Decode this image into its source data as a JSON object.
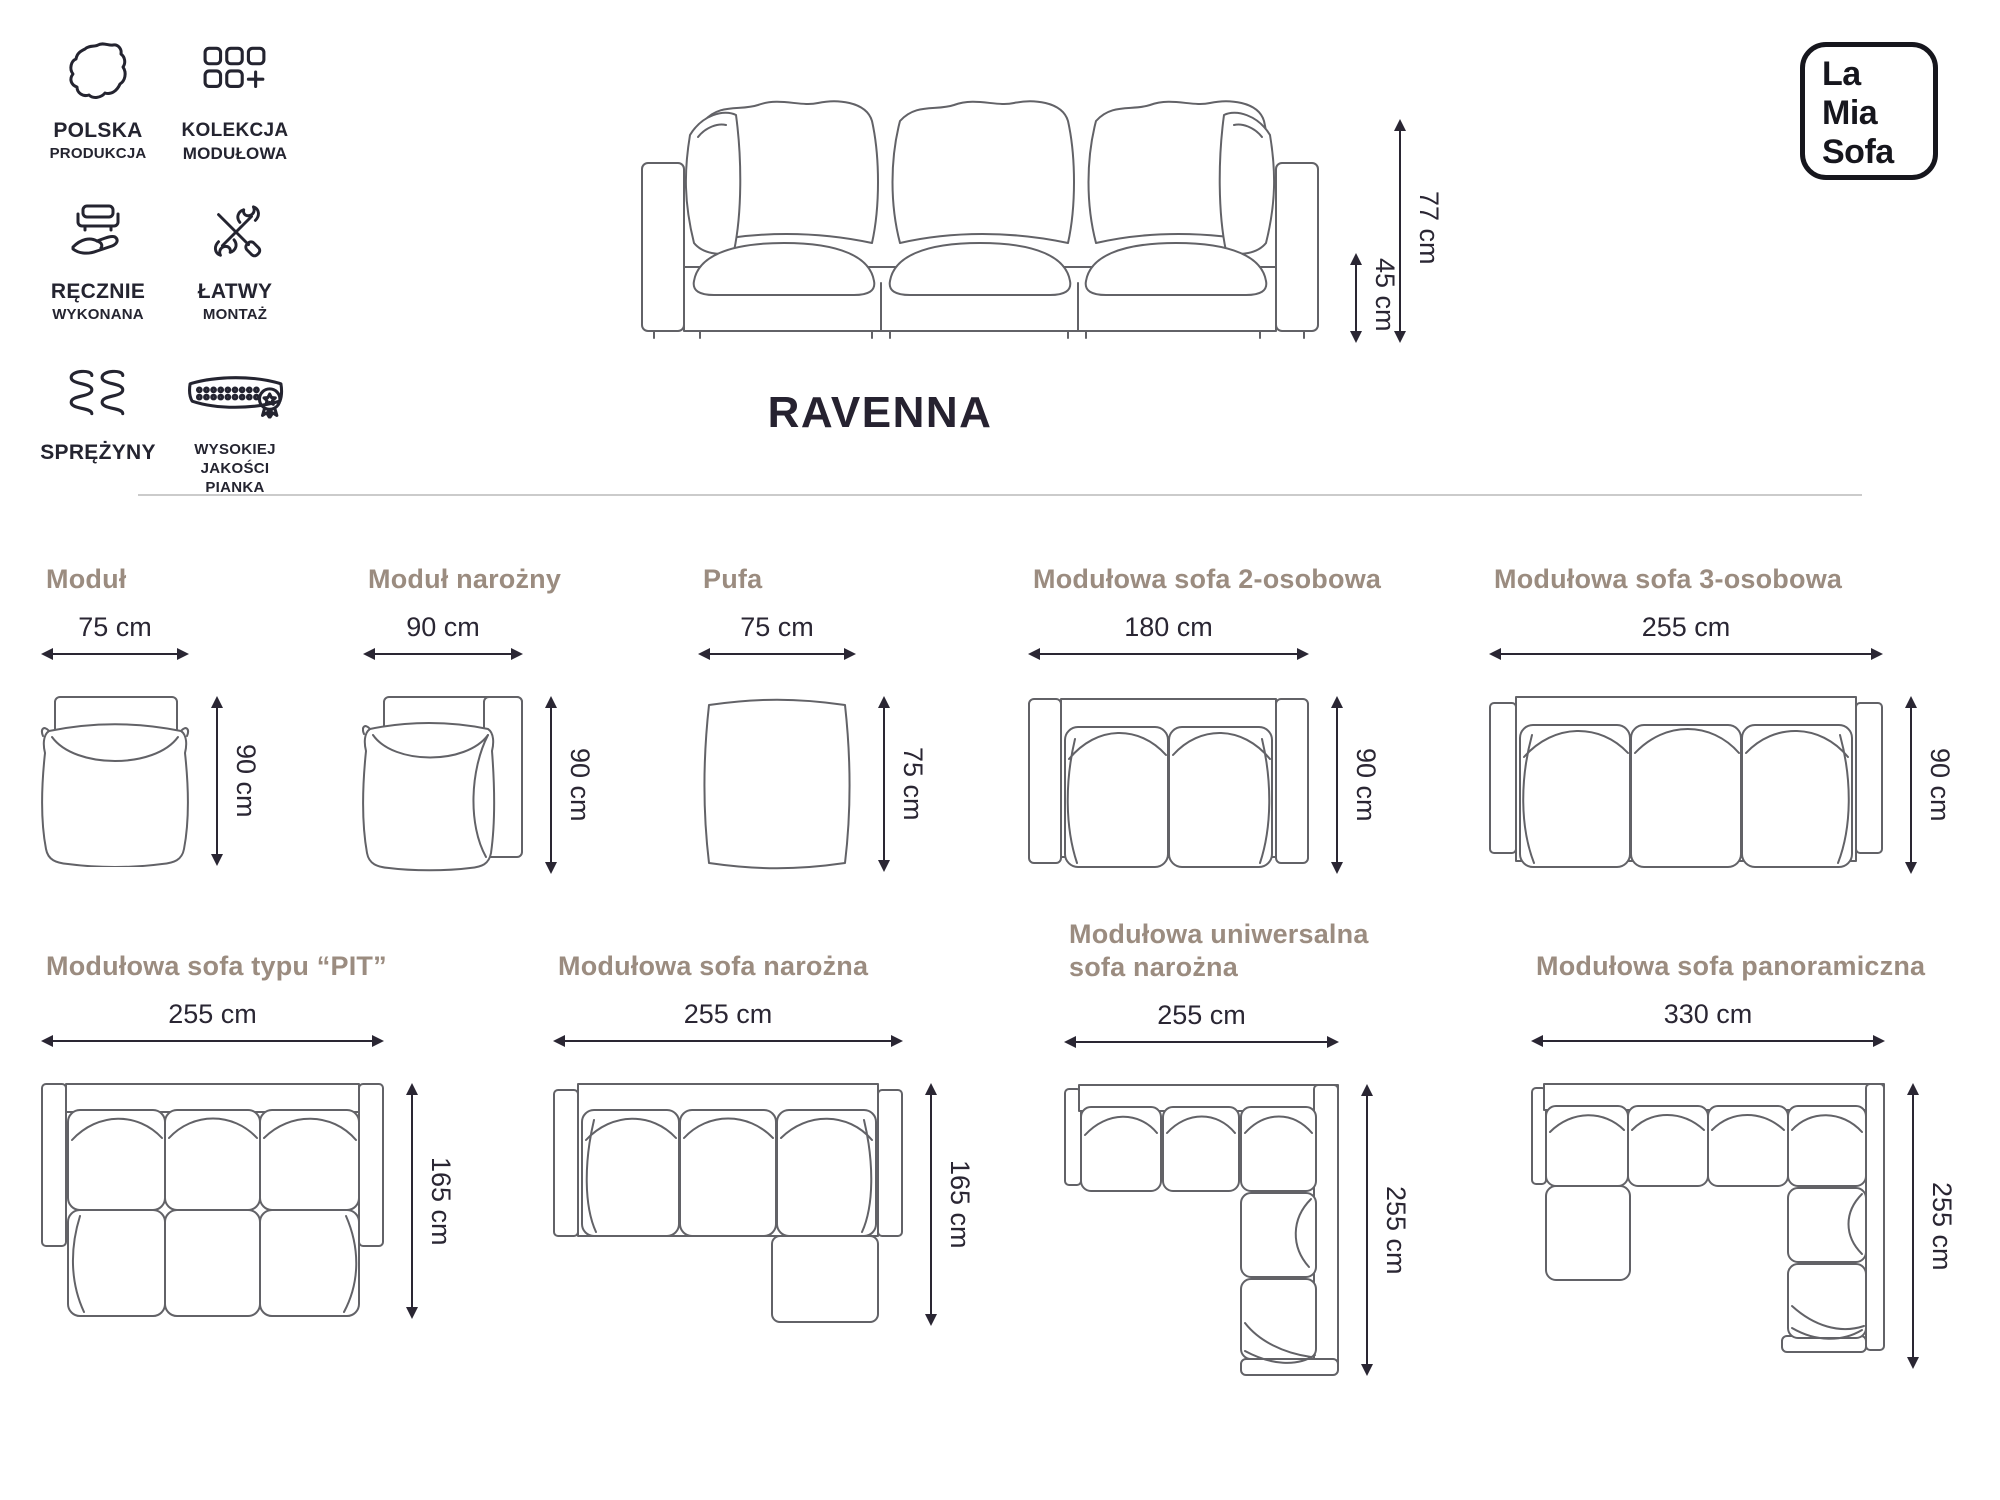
{
  "colors": {
    "label_accent": "#9b8c80",
    "ink": "#2a2633",
    "drawing_line": "#626267",
    "divider": "#cbcbcb",
    "logo_ink": "#16161d"
  },
  "badges": [
    {
      "icon": "poland-map-icon",
      "line1": "POLSKA",
      "line2": "PRODUKCJA"
    },
    {
      "icon": "modular-collection-icon",
      "line1": "KOLEKCJA",
      "line2": "MODUŁOWA"
    },
    {
      "icon": "handmade-icon",
      "line1": "RĘCZNIE",
      "line2": "WYKONANA"
    },
    {
      "icon": "easy-assembly-icon",
      "line1": "ŁATWY",
      "line2": "MONTAŻ"
    },
    {
      "icon": "springs-icon",
      "line1": "SPRĘŻYNY",
      "line2": ""
    },
    {
      "icon": "foam-quality-icon",
      "line1": "WYSOKIEJ",
      "line2": "JAKOŚCI PIANKA"
    }
  ],
  "logo": {
    "line1": "La",
    "line2": "Mia",
    "line3": "Sofa"
  },
  "hero": {
    "title": "RAVENNA",
    "total_height": "77 cm",
    "seat_height": "45 cm"
  },
  "variants": [
    {
      "name": "Moduł",
      "width": "75 cm",
      "depth": "90 cm"
    },
    {
      "name": "Moduł narożny",
      "width": "90 cm",
      "depth": "90 cm"
    },
    {
      "name": "Pufa",
      "width": "75 cm",
      "depth": "75 cm"
    },
    {
      "name": "Modułowa sofa 2-osobowa",
      "width": "180 cm",
      "depth": "90 cm"
    },
    {
      "name": "Modułowa sofa 3-osobowa",
      "width": "255 cm",
      "depth": "90 cm"
    },
    {
      "name": "Modułowa sofa typu “PIT”",
      "width": "255 cm",
      "depth": "165 cm"
    },
    {
      "name": "Modułowa sofa narożna",
      "width": "255 cm",
      "depth": "165 cm"
    },
    {
      "name": "Modułowa uniwersalna sofa narożna",
      "name_line1": "Modułowa uniwersalna",
      "name_line2": "sofa narożna",
      "width": "255 cm",
      "depth": "255 cm"
    },
    {
      "name": "Modułowa sofa panoramiczna",
      "width": "330 cm",
      "depth": "255 cm"
    }
  ]
}
